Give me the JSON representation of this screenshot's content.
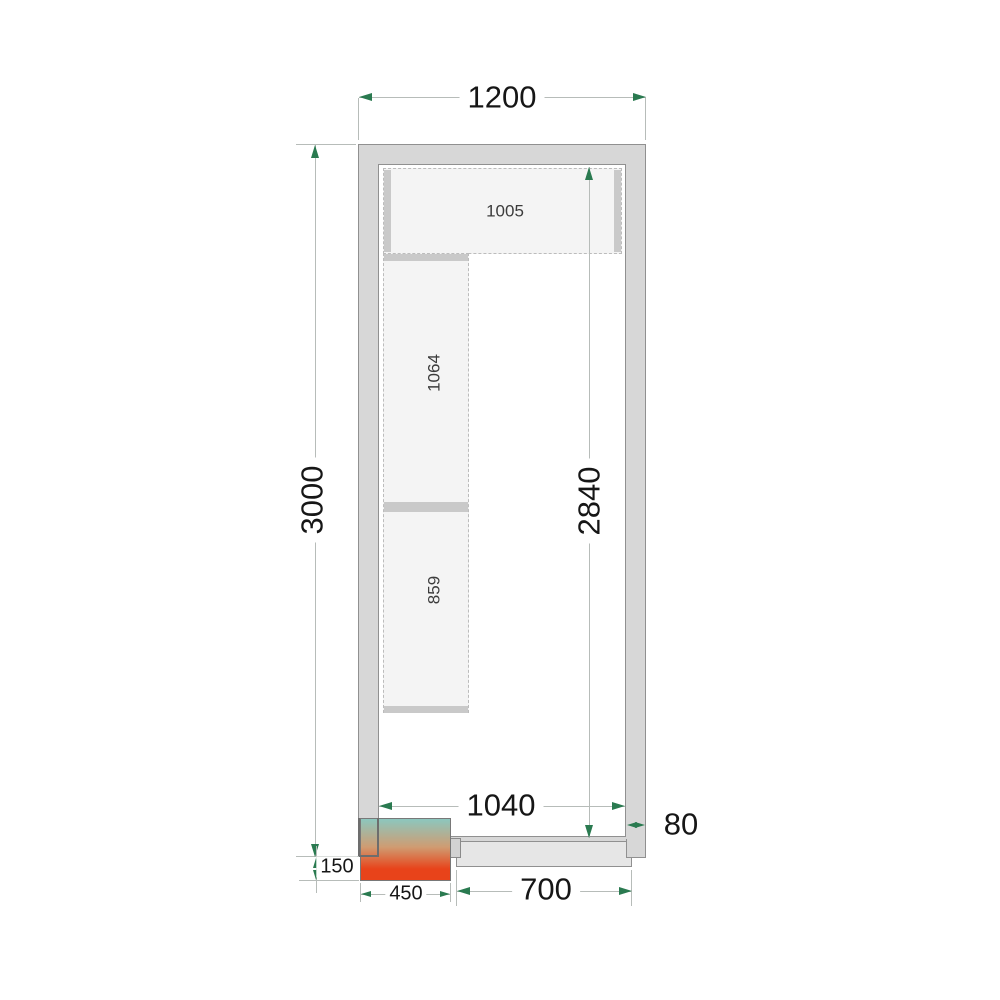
{
  "diagram": {
    "dims": {
      "outer_width": "1200",
      "outer_height": "3000",
      "inner_height": "2840",
      "inner_width": "1040",
      "wall_thickness": "80",
      "door_width": "700",
      "unit_width": "450",
      "unit_overhang": "150"
    },
    "shelves": {
      "top": "1005",
      "left_upper": "1064",
      "left_lower": "859"
    },
    "colors": {
      "wall_fill": "#d7d7d7",
      "wall_border": "#909090",
      "shelf_fill": "#f4f4f4",
      "shelf_edge": "#bcbcbc",
      "shelf_bar": "#c9c9c9",
      "door_fill": "#e6e6e6",
      "dim_line": "#b7bcb9",
      "arrow": "#2a7a50",
      "text": "#161616",
      "grad_top": "#8cc7be",
      "grad_mid": "#cf9c72",
      "grad_bottom": "#e8431a"
    }
  }
}
